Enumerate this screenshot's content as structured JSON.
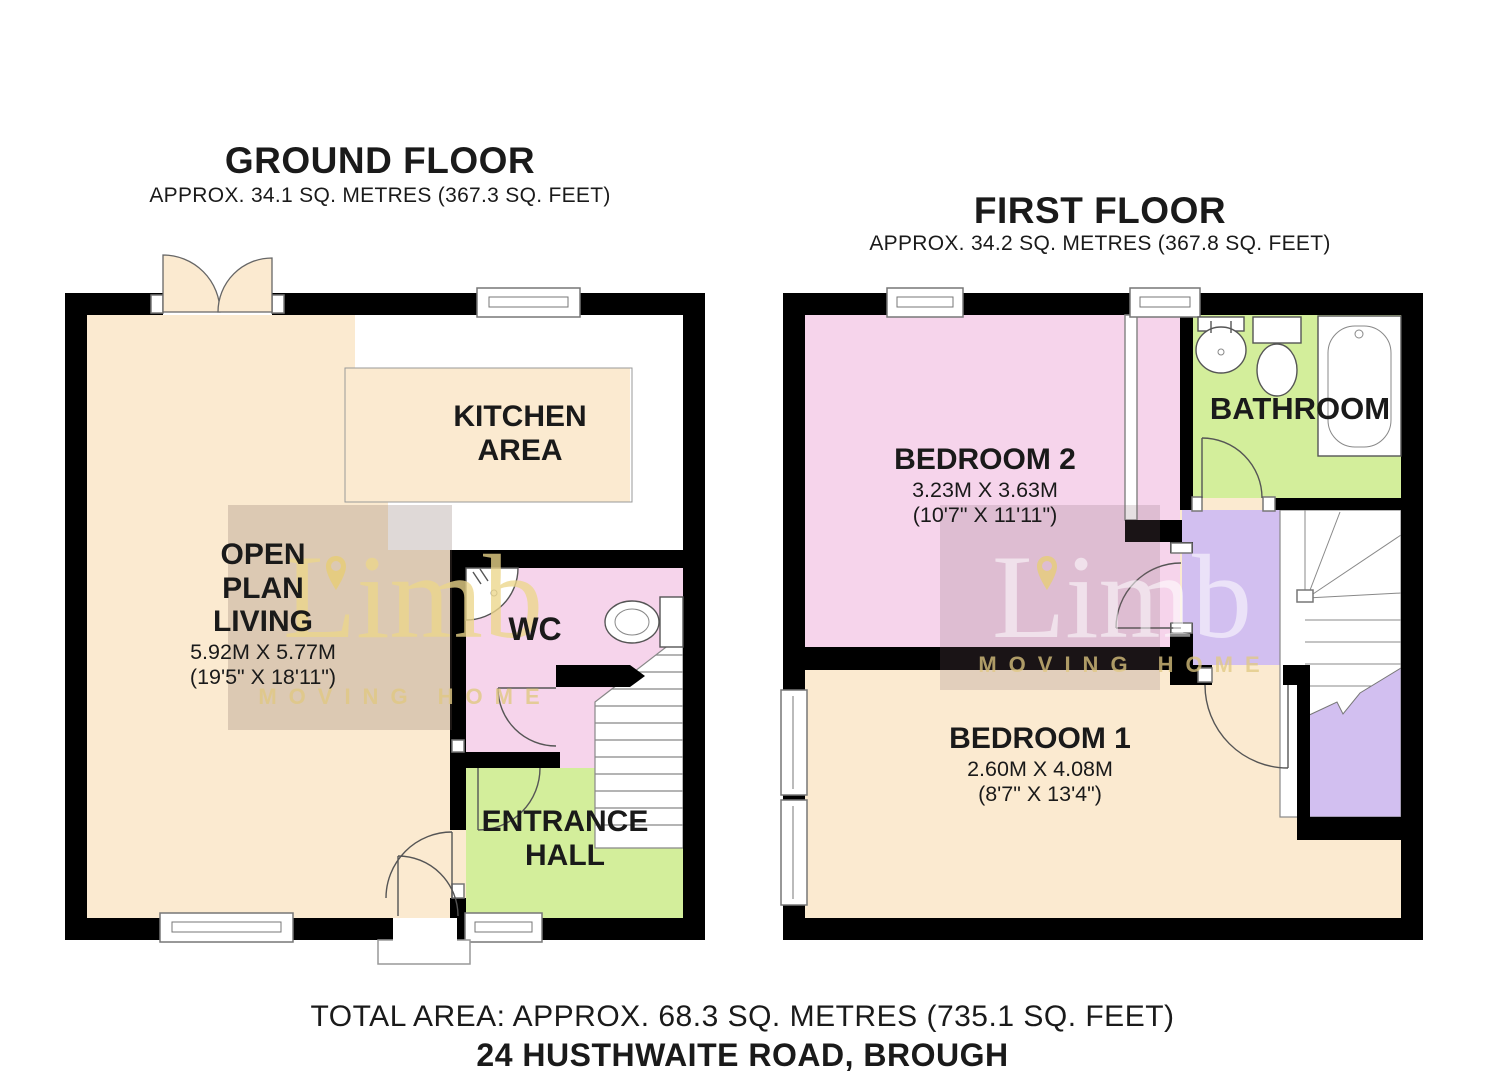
{
  "watermark": {
    "brand": "Limb",
    "tagline": "MOVING HOME"
  },
  "ground_floor": {
    "title": "GROUND FLOOR",
    "area": "APPROX. 34.1 SQ. METRES (367.3 SQ. FEET)",
    "rooms": {
      "kitchen": {
        "name": "KITCHEN AREA"
      },
      "living": {
        "name": "OPEN PLAN LIVING",
        "dims_metric": "5.92M X 5.77M",
        "dims_imperial": "(19'5\" X 18'11\")"
      },
      "wc": {
        "name": "WC"
      },
      "hall": {
        "name": "ENTRANCE HALL"
      }
    }
  },
  "first_floor": {
    "title": "FIRST FLOOR",
    "area": "APPROX. 34.2 SQ. METRES (367.8 SQ. FEET)",
    "rooms": {
      "bedroom2": {
        "name": "BEDROOM 2",
        "dims_metric": "3.23M X 3.63M",
        "dims_imperial": "(10'7\" X 11'11\")"
      },
      "bathroom": {
        "name": "BATHROOM"
      },
      "bedroom1": {
        "name": "BEDROOM 1",
        "dims_metric": "2.60M X 4.08M",
        "dims_imperial": "(8'7\" X 13'4\")"
      }
    }
  },
  "footer": {
    "total_area": "TOTAL AREA: APPROX. 68.3 SQ. METRES (735.1 SQ. FEET)",
    "address": "24 HUSTHWAITE ROAD, BROUGH"
  },
  "colors": {
    "floor_cream": "#fbead0",
    "room_pink": "#f6d4eb",
    "room_green": "#d3ee9b",
    "room_purple": "#d2bff0",
    "wall": "#000000",
    "watermark_gold": "#e0c684"
  }
}
